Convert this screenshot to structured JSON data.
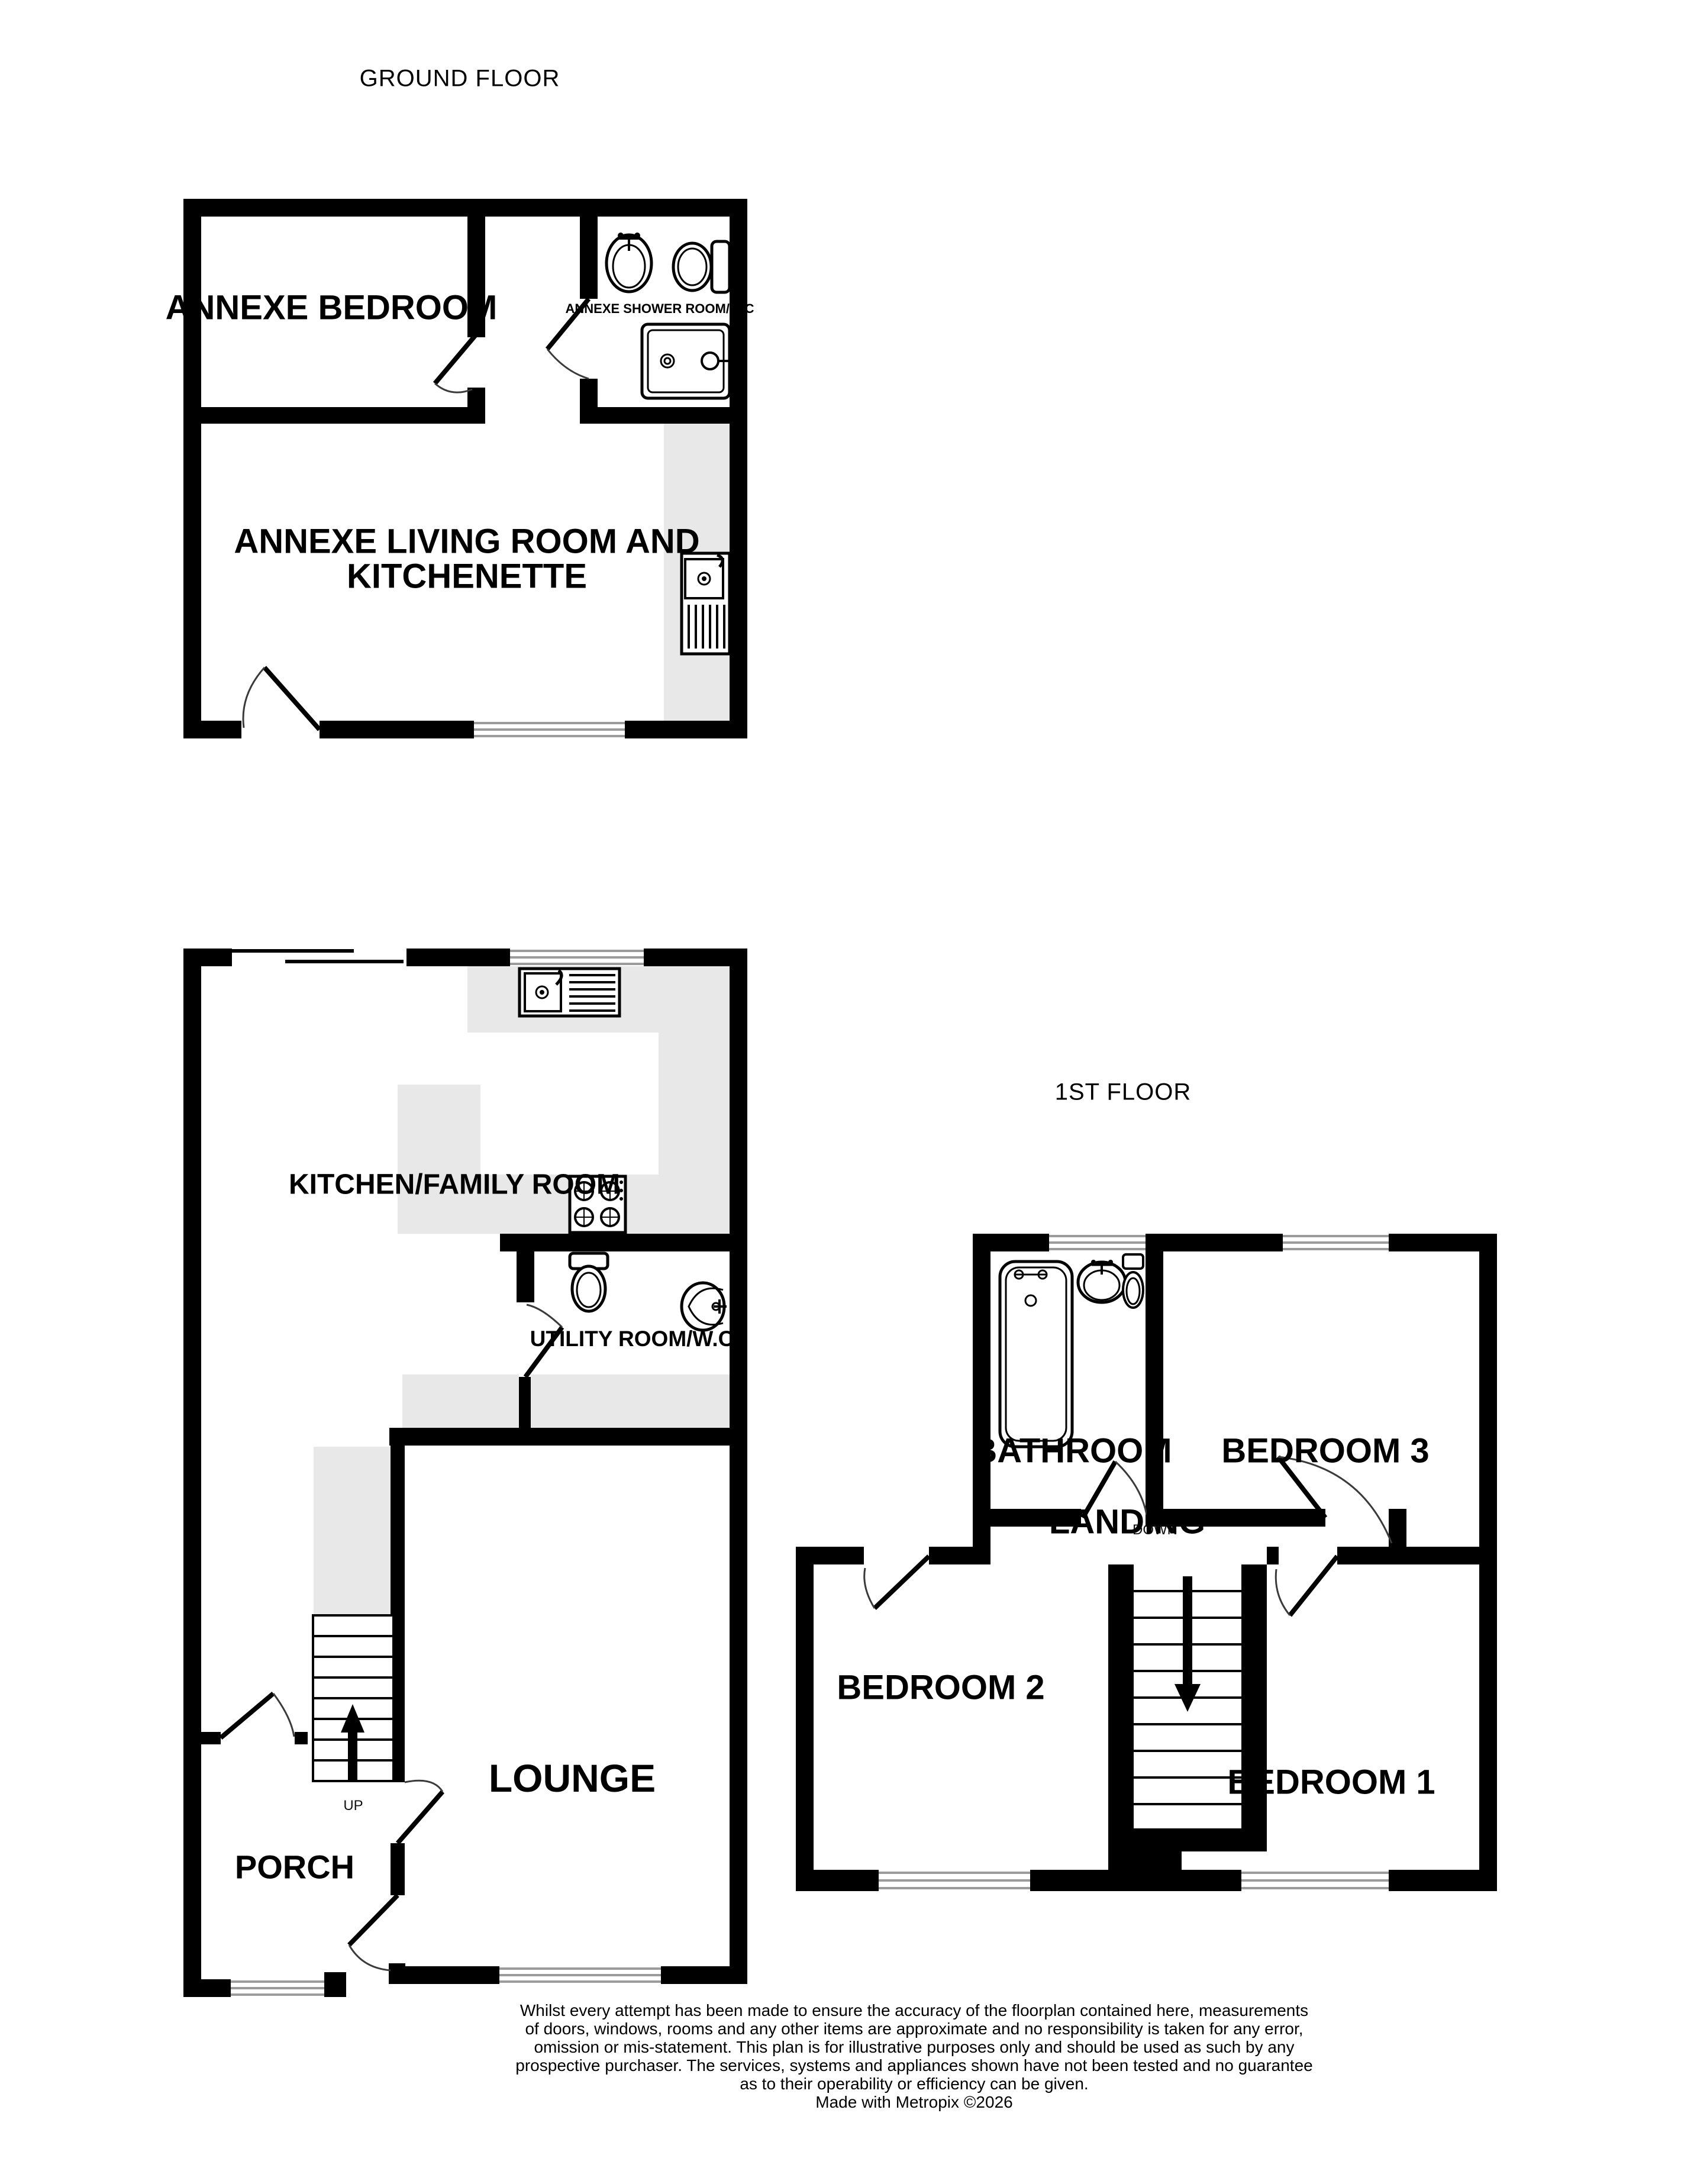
{
  "captions": {
    "ground_floor": "GROUND FLOOR",
    "first_floor": "1ST FLOOR"
  },
  "rooms": {
    "annexe_bedroom": "ANNEXE BEDROOM",
    "annexe_shower_room": "ANNEXE SHOWER ROOM/W.C",
    "annexe_living_line1": "ANNEXE LIVING ROOM AND",
    "annexe_living_line2": "KITCHENETTE",
    "kitchen_family": "KITCHEN/FAMILY ROOM",
    "utility": "UTILITY ROOM/W.C",
    "lounge": "LOUNGE",
    "porch": "PORCH",
    "bathroom": "BATHROOM",
    "bedroom1": "BEDROOM 1",
    "bedroom2": "BEDROOM 2",
    "bedroom3": "BEDROOM 3",
    "landing": "LANDING"
  },
  "stairs": {
    "up": "UP",
    "down": "DOWN"
  },
  "icons": [
    "sink-icon",
    "toilet-icon",
    "shower-tray-icon",
    "kitchen-sink-icon",
    "hob-icon",
    "bathtub-icon",
    "stairs-up-arrow-icon",
    "stairs-down-arrow-icon"
  ],
  "colors": {
    "wall": "#000000",
    "counter_fill": "#e8e8e8",
    "window_line": "#9b9b9b",
    "door_arc": "#3a3a3a"
  },
  "disclaimer": {
    "lines": [
      "Whilst every attempt has been made to ensure the accuracy of the floorplan contained here, measurements",
      "of doors, windows, rooms and any other items are approximate and no responsibility is taken for any error,",
      "omission or mis-statement. This plan is for illustrative purposes only and should be used as such by any",
      "prospective purchaser. The services, systems and appliances shown have not been tested and no guarantee",
      "as to their operability or efficiency can be given."
    ],
    "credit": "Made with Metropix ©2026"
  }
}
